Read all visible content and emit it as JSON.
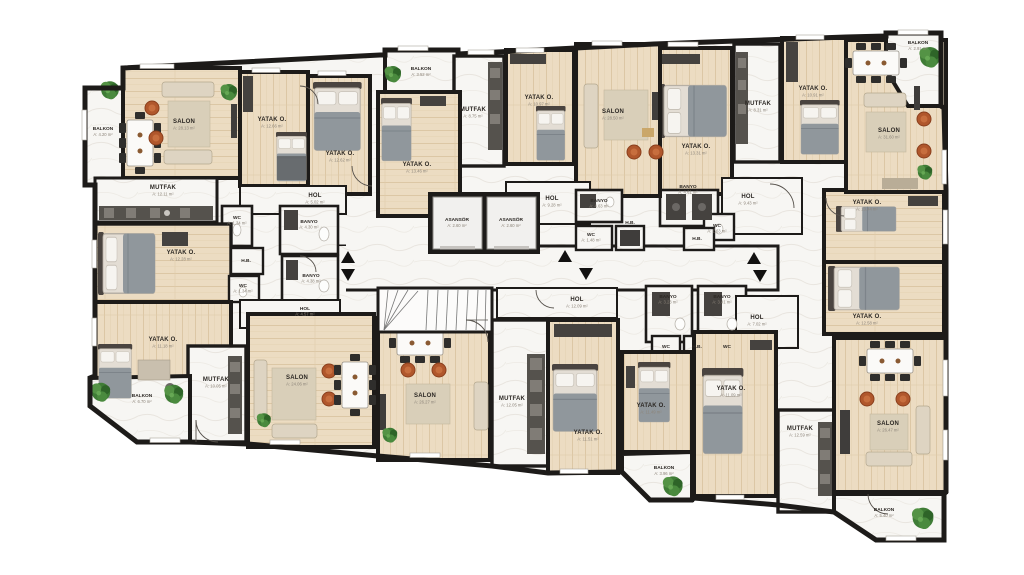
{
  "plan_type": "apartment-floor-plan",
  "language": "Turkish",
  "colors": {
    "wall": "#1d1b19",
    "wood_floor": "#ecdcc2",
    "marble_floor": "#f7f6f3",
    "accent_rust": "#b0572c",
    "plant_green": "#3f7c36",
    "furniture_dark": "#3f3d3b",
    "sofa_light": "#ded4c2"
  },
  "icons": {
    "plant": "plant-icon",
    "stairs_up": "stairs-up-arrow-icon",
    "stairs_down": "stairs-down-arrow-icon"
  },
  "rooms": {
    "balkon_a": {
      "label": "BALKON",
      "area": "A: 4.20 m²"
    },
    "salon_a": {
      "label": "SALON",
      "area": "A: 28.13 m²"
    },
    "yatak_a1": {
      "label": "YATAK O.",
      "area": "A: 12.66 m²"
    },
    "yatak_a2": {
      "label": "YATAK O.",
      "area": "A: 12.62 m²"
    },
    "mutfak_a": {
      "label": "MUTFAK",
      "area": "A: 12.11 m²"
    },
    "hol_a": {
      "label": "HOL",
      "area": "A: 5.02 m²"
    },
    "wc_a": {
      "label": "WC",
      "area": "A: 1.34 m²"
    },
    "banyo_a": {
      "label": "BANYO",
      "area": "A: 4.30 m²"
    },
    "yatak_f1": {
      "label": "YATAK O.",
      "area": "A: 12.28 m²"
    },
    "hb_f": {
      "label": "H.B."
    },
    "wc_f": {
      "label": "WC",
      "area": "A: 1.34 m²"
    },
    "banyo_f": {
      "label": "BANYO",
      "area": "A: 4.38 m²"
    },
    "hol_f": {
      "label": "HOL",
      "area": "A: 4.57 m²"
    },
    "yatak_f2": {
      "label": "YATAK O.",
      "area": "A: 11.18 m²"
    },
    "mutfak_f": {
      "label": "MUTFAK",
      "area": "A: 10.05 m²"
    },
    "balkon_f": {
      "label": "BALKON",
      "area": "A: 6.70 m²"
    },
    "salon_f": {
      "label": "SALON",
      "area": "A: 24.06 m²"
    },
    "salon_g": {
      "label": "SALON",
      "area": "A: 26.27 m²"
    },
    "mutfak_g": {
      "label": "MUTFAK",
      "area": "A: 12.05 m²"
    },
    "yatak_g": {
      "label": "YATAK O.",
      "area": "A: 11.51 m²"
    },
    "hol_g": {
      "label": "HOL",
      "area": "A: 12.09 m²"
    },
    "yatak_h1": {
      "label": "YATAK O.",
      "area": "A: 11.49 m²"
    },
    "balkon_h": {
      "label": "BALKON",
      "area": "A: 3.96 m²"
    },
    "yatak_h2": {
      "label": "YATAK O.",
      "area": "A: 11.09 m²"
    },
    "banyo_h1": {
      "label": "BANYO",
      "area": "A: 3.23 m²"
    },
    "banyo_h2": {
      "label": "BANYO",
      "area": "A: 3.41 m²"
    },
    "wc_h1": {
      "label": "WC"
    },
    "hb_h": {
      "label": "H.B."
    },
    "wc_h2": {
      "label": "WC"
    },
    "hol_h": {
      "label": "HOL",
      "area": "A: 7.02 m²"
    },
    "mutfak_e": {
      "label": "MUTFAK",
      "area": "A: 12.59 m²"
    },
    "salon_e": {
      "label": "SALON",
      "area": "A: 26.47 m²"
    },
    "balkon_e": {
      "label": "BALKON",
      "area": "A: 5.40 m²"
    },
    "yatak_e1": {
      "label": "YATAK O.",
      "area": "A: 13.44 m²"
    },
    "yatak_e2": {
      "label": "YATAK O.",
      "area": "A: 12.58 m²"
    },
    "salon_d": {
      "label": "SALON",
      "area": "A: 31.60 m²"
    },
    "balkon_d": {
      "label": "BALKON",
      "area": "A: 2.91 m²"
    },
    "yatak_d1": {
      "label": "YATAK O.",
      "area": "A: 13.31 m²"
    },
    "mutfak_d": {
      "label": "MUTFAK",
      "area": "A: 8.31 m²"
    },
    "yatak_d2": {
      "label": "YATAK O.",
      "area": "A: 10.91 m²"
    },
    "banyo_d": {
      "label": "BANYO",
      "area": "A: 4.61 m²"
    },
    "hol_d": {
      "label": "HOL",
      "area": "A: 9.43 m²"
    },
    "wc_d": {
      "label": "WC",
      "area": "A: 1.63 m²"
    },
    "hb_d": {
      "label": "H.B."
    },
    "salon_c": {
      "label": "SALON",
      "area": "A: 28.50 m²"
    },
    "yatak_c": {
      "label": "YATAK O.",
      "area": "A: 10.97 m²"
    },
    "mutfak_c": {
      "label": "MUTFAK",
      "area": "A: 8.75 m²"
    },
    "balkon_c": {
      "label": "BALKON",
      "area": "A: 3.52 m²"
    },
    "yatak_b": {
      "label": "YATAK O.",
      "area": "A: 13.46 m²"
    },
    "hol_b": {
      "label": "HOL",
      "area": "A: 9.28 m²"
    },
    "banyo_b": {
      "label": "BANYO",
      "area": "A: 4.63 m²"
    },
    "wc_b": {
      "label": "WC",
      "area": "A: 1.48 m²"
    },
    "hb_b": {
      "label": "H.B."
    },
    "asansor_1": {
      "label": "ASANSÖR",
      "area": "A: 2.60 m²"
    },
    "asansor_2": {
      "label": "ASANSÖR",
      "area": "A: 2.60 m²"
    }
  }
}
